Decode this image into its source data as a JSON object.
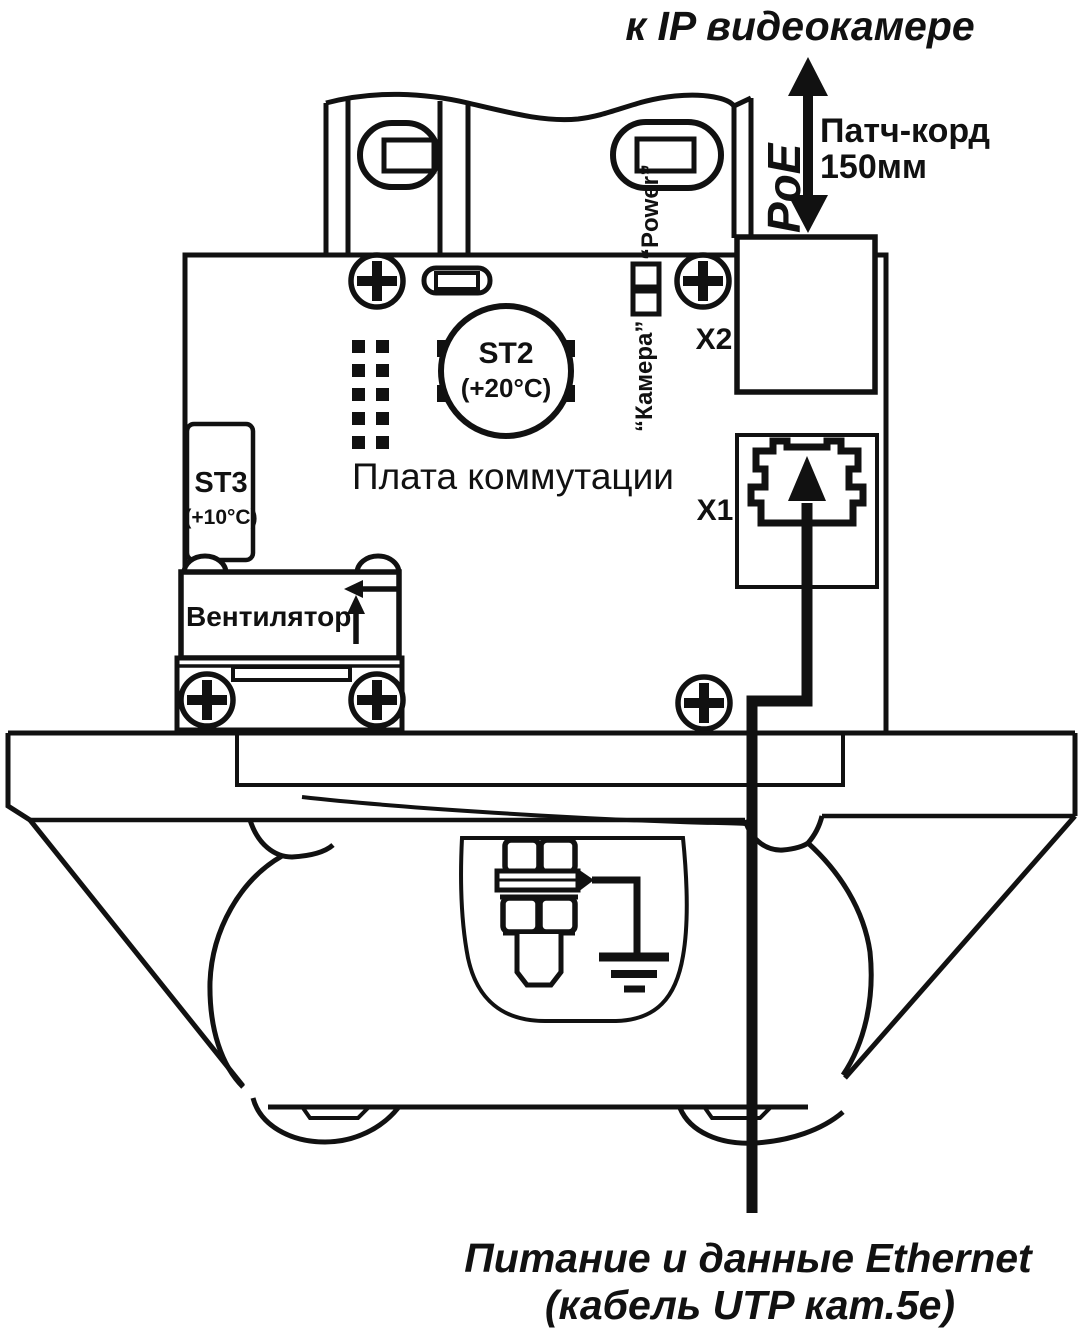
{
  "diagram": {
    "title_top": "к IP видеокамере",
    "poe_label": "PoE",
    "patch_cord_line1": "Патч-корд",
    "patch_cord_line2": "150мм",
    "board_label": "Плата коммутации",
    "st2_name": "ST2",
    "st2_temp": "(+20°C)",
    "st3_name": "ST3",
    "st3_temp": "(+10°C)",
    "fan_label": "Вентилятор",
    "led_power_label": "“Power”",
    "led_camera_label": "“Камера”",
    "connector_x1": "X1",
    "connector_x2": "X2",
    "bottom_caption_line1": "Питание и данные Ethernet",
    "bottom_caption_line2": "(кабель UTP кат.5е)"
  },
  "colors": {
    "ink": "#111111",
    "background": "#ffffff"
  }
}
